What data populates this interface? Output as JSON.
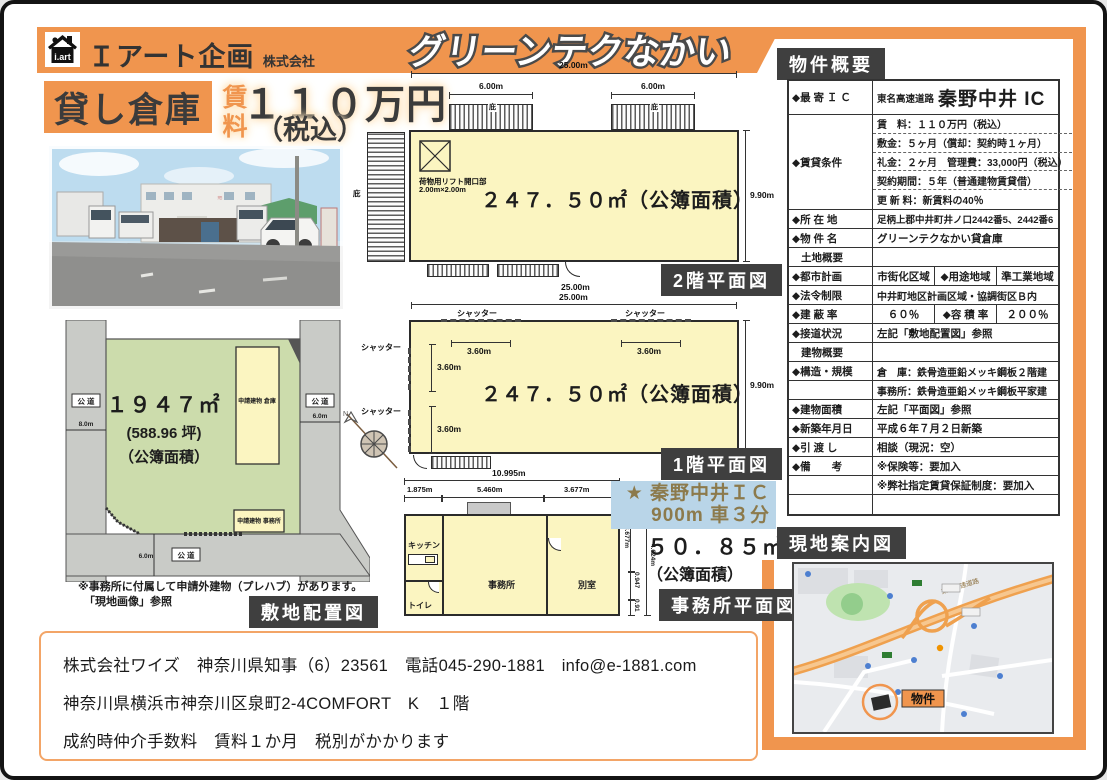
{
  "header": {
    "logo_text": "i.art",
    "company": "Ｉアート企画",
    "company_suffix": "株式会社",
    "property_title": "グリーンテクなかい"
  },
  "hero": {
    "badge": "貸し倉庫",
    "rent_label": "賃料",
    "price": "１１０万円",
    "tax": "（税込）"
  },
  "colors": {
    "accent_orange": "#F0954E",
    "badge_dark": "#3F3F3F",
    "plan_yellow": "#FBF5C1",
    "site_green": "#CCDCAC",
    "access_blue": "#B9D5E8",
    "access_text": "#8C7A4C"
  },
  "floor2": {
    "caption": "2階平面図",
    "dim_top": "25.00m",
    "dim_bottom": "25.00m",
    "eave_dim": "6.00m",
    "eave_label": "庇",
    "height_dim": "9.90m",
    "lift_line1": "荷物用リフト開口部",
    "lift_line2": "2.00m×2.00m",
    "area": "２４７．５０㎡（公簿面積）"
  },
  "floor1": {
    "caption": "1階平面図",
    "dim_top": "25.00m",
    "height_dim": "9.90m",
    "shutter": "シャッター",
    "shutter_dim": "3.60m",
    "area": "２４７．５０㎡（公簿面積）",
    "north": "N"
  },
  "office": {
    "caption": "事務所平面図",
    "dim_total": "10.995m",
    "seg1": "1.875m",
    "seg2": "5.460m",
    "seg3": "3.677m",
    "right1": "3.677m",
    "right2": "0.947",
    "right3": "0.91",
    "right_outer": "4.624m",
    "kitchen": "キッチン",
    "office_room": "事務所",
    "other_room": "別室",
    "toilet": "トイレ"
  },
  "office_area": {
    "line1": "５０．８５㎡",
    "line2": "（公簿面積）"
  },
  "access": {
    "line1": "★ 秦野中井ＩＣ",
    "line2": "900m 車３分"
  },
  "site": {
    "caption": "敷地配置図",
    "area1": "１９４７㎡",
    "area2": "(588.96 坪)",
    "area3": "（公簿面積）",
    "bldg1": "申請建物 倉庫",
    "bldg2": "申請建物 事務所",
    "road": "公 道",
    "dim_left": "8.0m",
    "dim_right": "6.0m",
    "dim_bottom": "6.0m",
    "note1": "※事務所に付属して申請外建物（プレハブ）があります。",
    "note2": "「現地画像」参照"
  },
  "overview": {
    "title": "物件概要",
    "r_ic": {
      "label": "◆最 寄 Ｉ Ｃ",
      "pre": "東名高速道路",
      "value": "秦野中井 IC"
    },
    "r_rental": {
      "label": "◆賃貸条件",
      "l1": "賃　料：１１０万円（税込）",
      "l2": "敷金：５ヶ月（償却：契約時１ヶ月）",
      "l3": "礼金：２ヶ月　管理費：33,000円（税込）",
      "l4": "契約期間：５年（普通建物賃貸借）",
      "l5": "更 新 料：新賃料の40％"
    },
    "r_addr": {
      "label": "◆所 在 地",
      "value": "足柄上郡中井町井ノ口2442番5、2442番6"
    },
    "r_name": {
      "label": "◆物 件 名",
      "value": "グリーンテクなかい貸倉庫"
    },
    "r_land": {
      "label": "土地概要"
    },
    "r_city": {
      "label": "◆都市計画",
      "value": "市街化区域",
      "label2": "◆用途地域",
      "value2": "準工業地域"
    },
    "r_law": {
      "label": "◆法令制限",
      "value": "中井町地区計画区域・協調街区Ｂ内"
    },
    "r_bcr": {
      "label": "◆建 蔽 率",
      "value": "６０％",
      "label2": "◆容 積 率",
      "value2": "２００％"
    },
    "r_road": {
      "label": "◆接道状況",
      "value": "左記「敷地配置図」参照"
    },
    "r_bldg": {
      "label": "建物概要"
    },
    "r_struct": {
      "label": "◆構造・規模",
      "value": "倉　庫：鉄骨造亜鉛メッキ鋼板２階建",
      "value2": "事務所：鉄骨造亜鉛メッキ鋼板平家建"
    },
    "r_barea": {
      "label": "◆建物面積",
      "value": "左記「平面図」参照"
    },
    "r_built": {
      "label": "◆新築年月日",
      "value": "平成６年７月２日新築"
    },
    "r_handover": {
      "label": "◆引 渡 し",
      "value": "相談（現況：空）"
    },
    "r_note": {
      "label": "◆備　　考",
      "value": "※保険等：要加入",
      "value2": "※弊社指定賃貸保証制度：要加入"
    }
  },
  "map": {
    "title": "現地案内図",
    "property_label": "物件",
    "highway_label": "東名高速道路"
  },
  "footer": {
    "line1": "株式会社ワイズ　神奈川県知事（6）23561　電話045-290-1881　info@e-1881.com",
    "line2": "神奈川県横浜市神奈川区泉町2-4COMFORT　K　１階",
    "line3": "成約時仲介手数料　賃料１か月　税別がかかります"
  }
}
